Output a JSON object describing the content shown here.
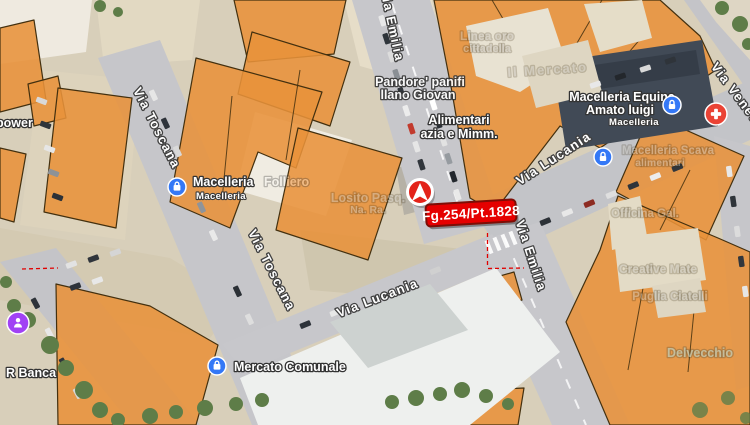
{
  "marker": {
    "plate": "Fg.254/Pt.1828"
  },
  "streets": {
    "via_emilia": "Via Emilia",
    "via_lucania": "Via Lucania",
    "via_toscana": "Via Toscana",
    "via_veneto": "Via Veneto"
  },
  "places": {
    "alimentari_line1": "Alimentari",
    "alimentari_line2": "azia e Mimm.",
    "equina_line1": "Macelleria Equina",
    "equina_line2": "Amato luigi",
    "equina_category": "Macelleria",
    "folliero_part1": "Macelleria",
    "folliero_part2": "Folliero",
    "folliero_category": "Macelleria",
    "mercato_comunale": "Mercato Comunale",
    "r_banca": "R Banca",
    "power": "power",
    "pandore_line1": "Pandore' panifi",
    "pandore_line2": "llano Giovan"
  },
  "faint_places": [
    {
      "text": "Linea oro"
    },
    {
      "text": "cittadella"
    },
    {
      "text": "Il Mercato"
    },
    {
      "text": "Losito Pasq."
    },
    {
      "text": "Na. Ra."
    },
    {
      "text": "Officina Gal."
    },
    {
      "text": "Creative Mate"
    },
    {
      "text": "Puglia Ciatelli"
    },
    {
      "text": "Macelleria Scava"
    },
    {
      "text": "alimentari"
    },
    {
      "text": "Delvecchio"
    }
  ],
  "colors": {
    "overlay_fill": "#E8923A",
    "overlay_border": "#43300F",
    "plate_bg": "#E50000",
    "marker_red": "#E3231A",
    "poi_blue": "#3478F6",
    "health_red": "#EA4335",
    "poi_purple": "#A142F4"
  }
}
